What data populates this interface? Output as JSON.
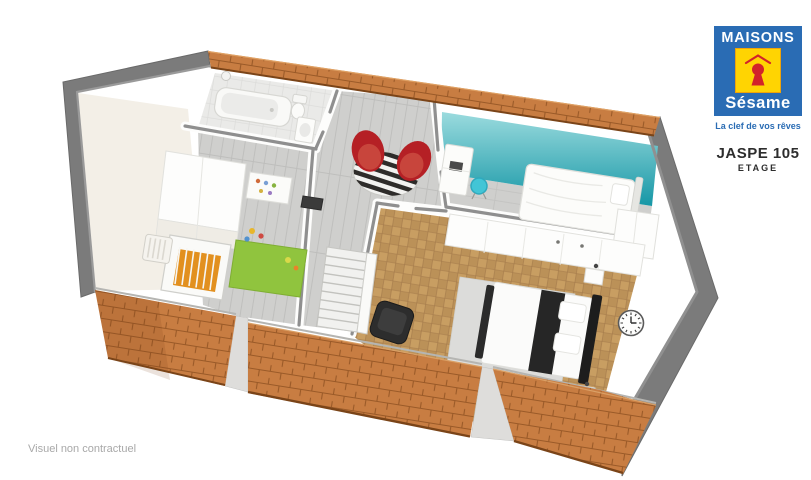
{
  "window": {
    "width": 811,
    "height": 480,
    "background": "#ffffff"
  },
  "branding": {
    "logo": {
      "line1": "MAISONS",
      "line2": "Sésame",
      "tagline": "La clef de vos rêves",
      "colors": {
        "blue": "#2a6cb4",
        "yellow": "#ffd402",
        "keyhole_red": "#d2232a",
        "text_white": "#ffffff"
      }
    },
    "model": {
      "name": "JASPE 105",
      "floor_label": "ETAGE"
    }
  },
  "footer": {
    "disclaimer": "Visuel non contractuel"
  },
  "floorplan": {
    "type": "3d-cutaway-floor-plan",
    "colors": {
      "roof": "#c87d42",
      "roof_line": "#9a5a28",
      "roof_shadow": "#7a4418",
      "outer_wall": "#7b7b7b",
      "wall_top": "#8f8f8f",
      "attic_wall_cream": "#f3efe7",
      "floor_wood": "#cfcfcd",
      "floor_bathroom": "#eaeae8",
      "floor_parquet": "#c89e62",
      "teal_wall_top": "#9bdbde",
      "teal_wall_bottom": "#1697a6",
      "armchair_red": "#b52025",
      "seat_red_light": "#c8453c",
      "rug_green": "#90c43e",
      "chair_teal": "#42c5d6",
      "furniture_black": "#262626",
      "rug_gray": "#dcdcda",
      "furniture_white": "#fcfcfa"
    },
    "rooms": [
      {
        "id": "salle-de-bains",
        "position": "top",
        "items": [
          "bathtub",
          "shower-head",
          "toilet",
          "washbasin"
        ]
      },
      {
        "id": "chambre-enfant",
        "position": "left",
        "items": [
          "wardrobe",
          "baby-crib",
          "green-rug",
          "toy-shelf",
          "toys",
          "radiator",
          "door-mat"
        ]
      },
      {
        "id": "palier",
        "position": "center",
        "items": [
          "red-armchair",
          "red-armchair",
          "striped-round-rug",
          "staircase"
        ]
      },
      {
        "id": "chambre-2",
        "position": "right",
        "items": [
          "single-bed",
          "desk",
          "teal-desk-chair",
          "wardrobe",
          "teal-accent-wall"
        ]
      },
      {
        "id": "chambre-parentale",
        "position": "bottom-right",
        "items": [
          "double-bed",
          "black-throw",
          "pillows",
          "nightstand",
          "nightstand",
          "wardrobe",
          "gray-rug",
          "black-armchair",
          "wall-clock",
          "wall-lamps"
        ]
      }
    ],
    "roof": {
      "material": "terracotta-tiles",
      "segments": [
        "top-strip",
        "front-left",
        "front-center",
        "front-right"
      ]
    }
  }
}
